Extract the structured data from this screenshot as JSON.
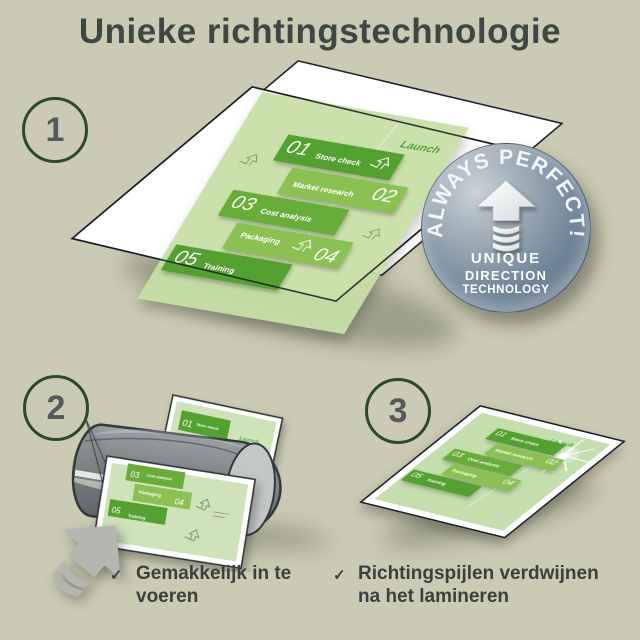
{
  "title": "Unieke richtingstechnologie",
  "steps": {
    "one": "1",
    "two": "2",
    "three": "3"
  },
  "badge": {
    "arc_text": "ALWAYS PERFECT!",
    "line1": "UNIQUE",
    "line2": "DIRECTION",
    "line3": "TECHNOLOGY"
  },
  "doc": {
    "launch_label": "Launch",
    "items": [
      {
        "num": "01",
        "label": "Store check"
      },
      {
        "num": "02",
        "label": "Market research"
      },
      {
        "num": "03",
        "label": "Cost analysis"
      },
      {
        "num": "04",
        "label": "Packaging"
      },
      {
        "num": "05",
        "label": "Training"
      }
    ]
  },
  "captions": {
    "check_glyph": "✓",
    "step2": "Gemakkelijk in te voeren",
    "step3": "Richtingspijlen verdwijnen na het lamineren"
  },
  "colors": {
    "background": "#cbcab4",
    "heading_text": "#3f4743",
    "brand_green_dark": "#54a031",
    "brand_green_light": "#8bc153",
    "page_green": "#cfe3ba",
    "badge_blue": "#71869a",
    "laminator_gray": "#7e8486"
  }
}
